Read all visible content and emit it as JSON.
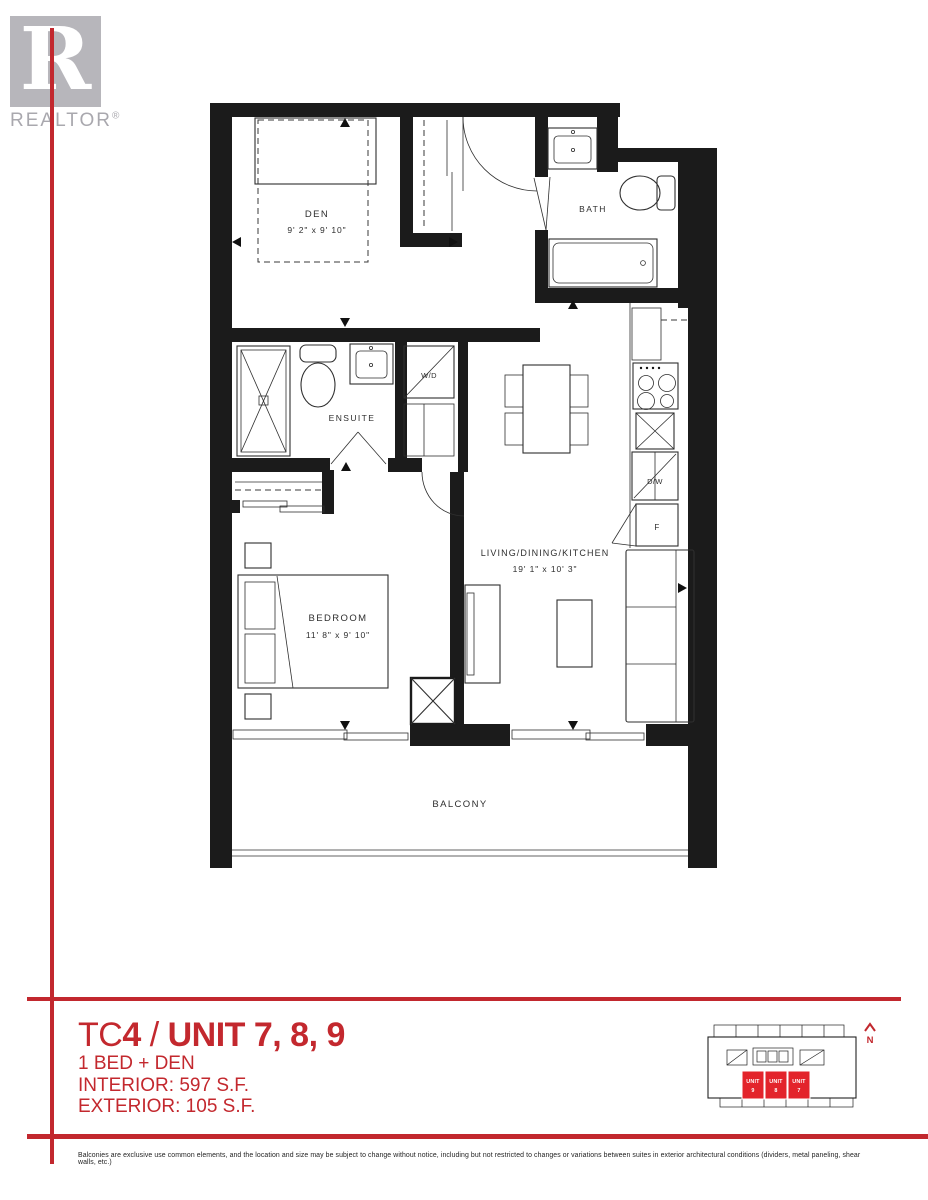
{
  "logo": {
    "letter": "R",
    "caption": "REALTOR",
    "registered": "®"
  },
  "floor_plan": {
    "den": {
      "label": "DEN",
      "dims": "9' 2\" x 9' 10\""
    },
    "bath": {
      "label": "BATH"
    },
    "ensuite": {
      "label": "ENSUITE"
    },
    "laundry": {
      "label": "W/D"
    },
    "bedroom": {
      "label": "BEDROOM",
      "dims": "11' 8\" x 9' 10\""
    },
    "living": {
      "label": "LIVING/DINING/KITCHEN",
      "dims": "19' 1\" x 10' 3\""
    },
    "balcony": {
      "label": "BALCONY"
    },
    "dishwasher": {
      "label": "D/W"
    },
    "fridge": {
      "label": "F"
    }
  },
  "title_block": {
    "project": "TC",
    "project_num": "4",
    "separator": " / ",
    "unit": "UNIT 7, 8, 9",
    "type": "1 BED + DEN",
    "interior": "INTERIOR: 597 S.F.",
    "exterior": "EXTERIOR: 105 S.F."
  },
  "key_plan": {
    "units": [
      {
        "line1": "UNIT",
        "line2": "9"
      },
      {
        "line1": "UNIT",
        "line2": "8"
      },
      {
        "line1": "UNIT",
        "line2": "7"
      }
    ],
    "north": "N"
  },
  "disclaimer": "Balconies are exclusive use common elements, and the location and size may be subject to change without notice, including but not restricted to changes or variations between suites in exterior architectural conditions (dividers, metal paneling, shear walls, etc.)",
  "colors": {
    "accent_red": "#c2282e",
    "unit_red": "#e3242b",
    "wall_black": "#1b1b1b"
  }
}
